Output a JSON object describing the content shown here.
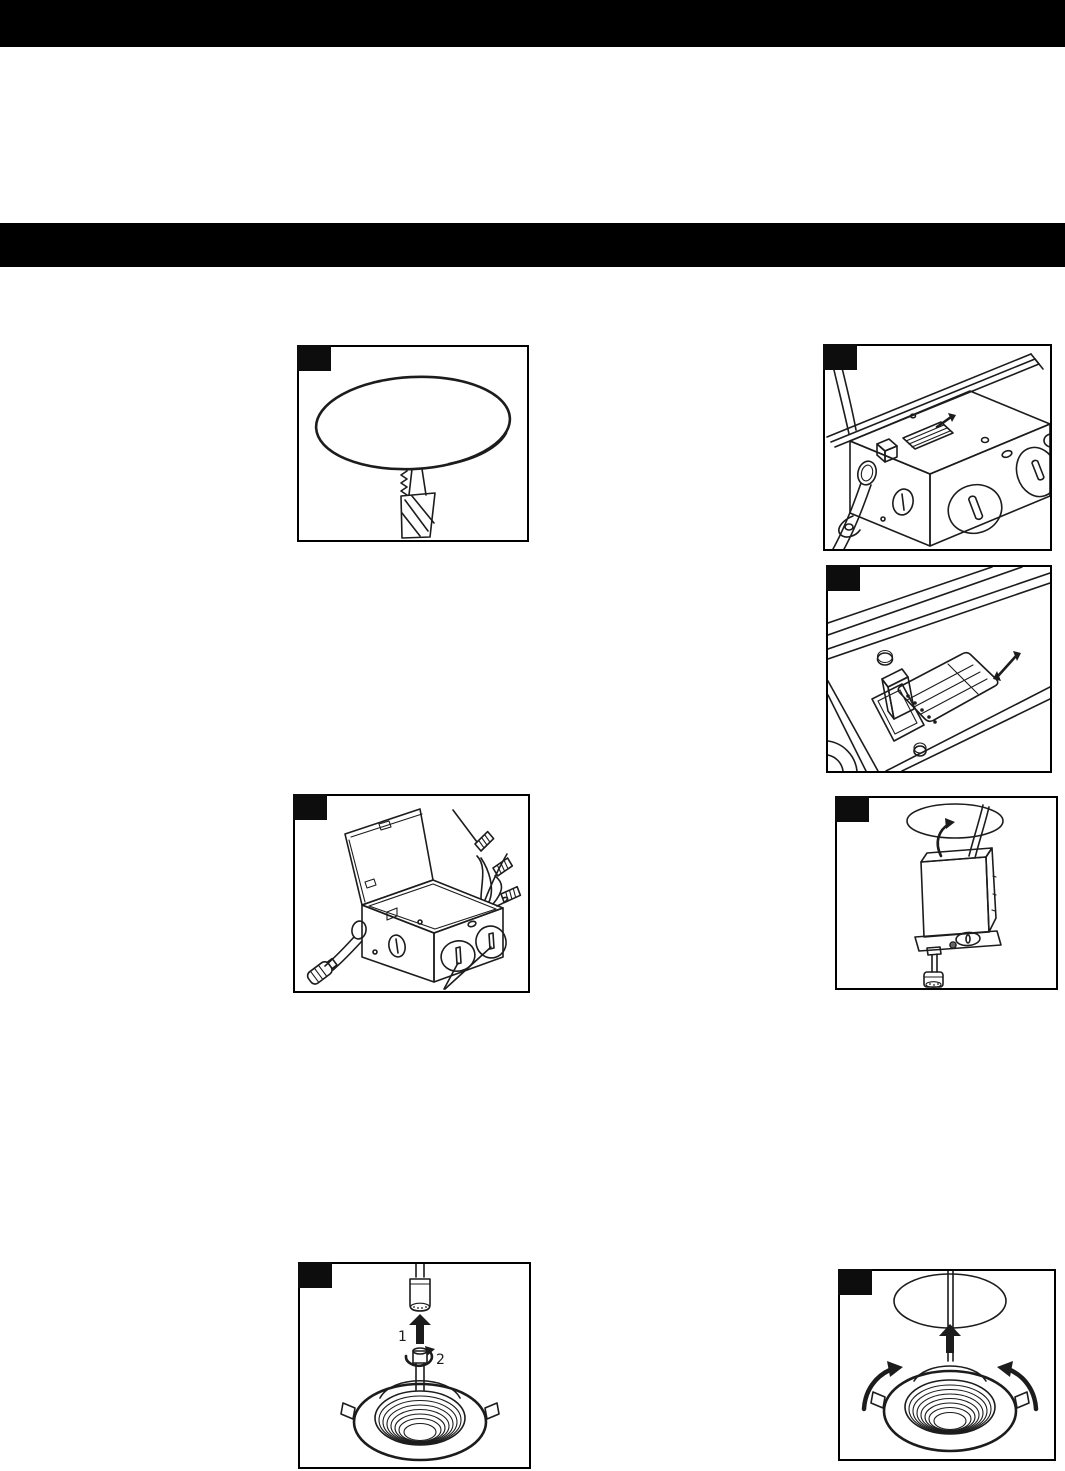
{
  "colors": {
    "background": "#ffffff",
    "banner": "#000000",
    "line_art": "#1c1c1c",
    "step_badge": "#0d0d0d"
  },
  "banners": {
    "top": "",
    "section": ""
  },
  "figures": [
    {
      "name": "cut-ceiling-hole-with-hole-saw"
    },
    {
      "name": "junction-box-isometric-with-cct-switch"
    },
    {
      "name": "cct-selector-switch-closeup"
    },
    {
      "name": "junction-box-open-lid-wire-nuts"
    },
    {
      "name": "junction-box-pushed-into-ceiling-hole"
    },
    {
      "name": "attach-downlight-connector",
      "steps": [
        "1",
        "2"
      ]
    },
    {
      "name": "push-downlight-into-ceiling"
    }
  ]
}
